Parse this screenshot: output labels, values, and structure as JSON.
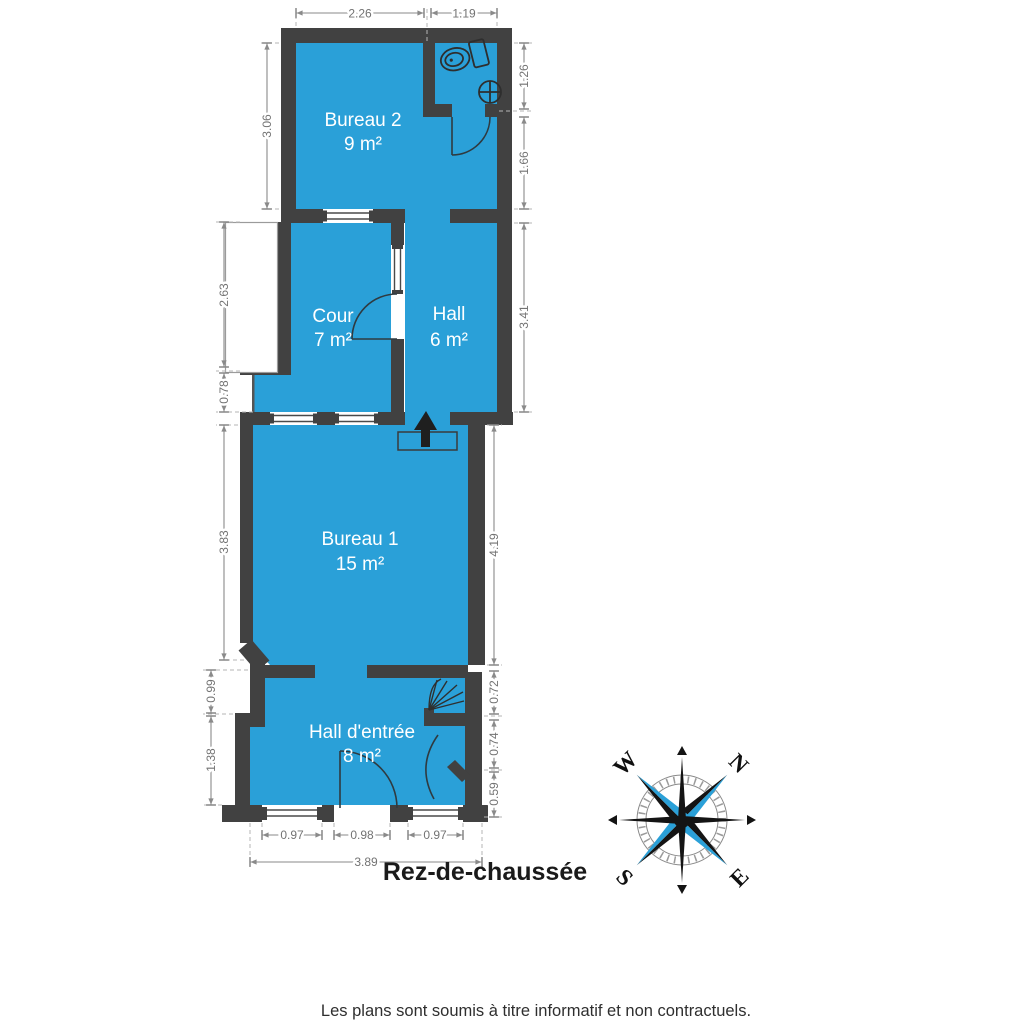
{
  "plan": {
    "title": "Rez-de-chaussée",
    "disclaimer": "Les plans sont soumis à titre informatif et non contractuels.",
    "rooms": [
      {
        "name": "Bureau 2",
        "area": "9 m²"
      },
      {
        "name": "Cour",
        "area": "7 m²"
      },
      {
        "name": "Hall",
        "area": "6 m²"
      },
      {
        "name": "Bureau 1",
        "area": "15 m²"
      },
      {
        "name": "Hall d'entrée",
        "area": "8 m²"
      }
    ],
    "dimensions": {
      "top": {
        "bureau2_width": "2.26",
        "wc_width": "1.19"
      },
      "left": {
        "bureau2_height": "3.06",
        "cour_height": "2.63",
        "cour_lower": "0.78",
        "bureau1_height": "3.83",
        "hall_entree_upper": "0.99",
        "hall_entree_lower": "1.38"
      },
      "right": {
        "wc_height": "1.26",
        "corridor_height": "1.66",
        "hall_height": "3.41",
        "bureau1_height": "4.19",
        "stair_recess": "0.72",
        "mid_recess": "0.74",
        "lower_recess": "0.59"
      },
      "bottom": {
        "window_left": "0.97",
        "entry_door": "0.98",
        "window_right": "0.97",
        "total_width": "3.89"
      }
    },
    "compass": {
      "north": "N",
      "east": "E",
      "south": "S",
      "west": "W"
    },
    "colors": {
      "room_fill": "#2AA0D8",
      "wall": "#414141",
      "dimension_gray": "#8A8A8A",
      "compass_accent": "#2AA0D8"
    },
    "icons": {
      "toilet": "toilet-icon",
      "sink": "sink-icon",
      "stairs": "stairs-icon",
      "entrance_arrow": "entrance-arrow-icon",
      "compass": "compass-rose-icon"
    }
  }
}
